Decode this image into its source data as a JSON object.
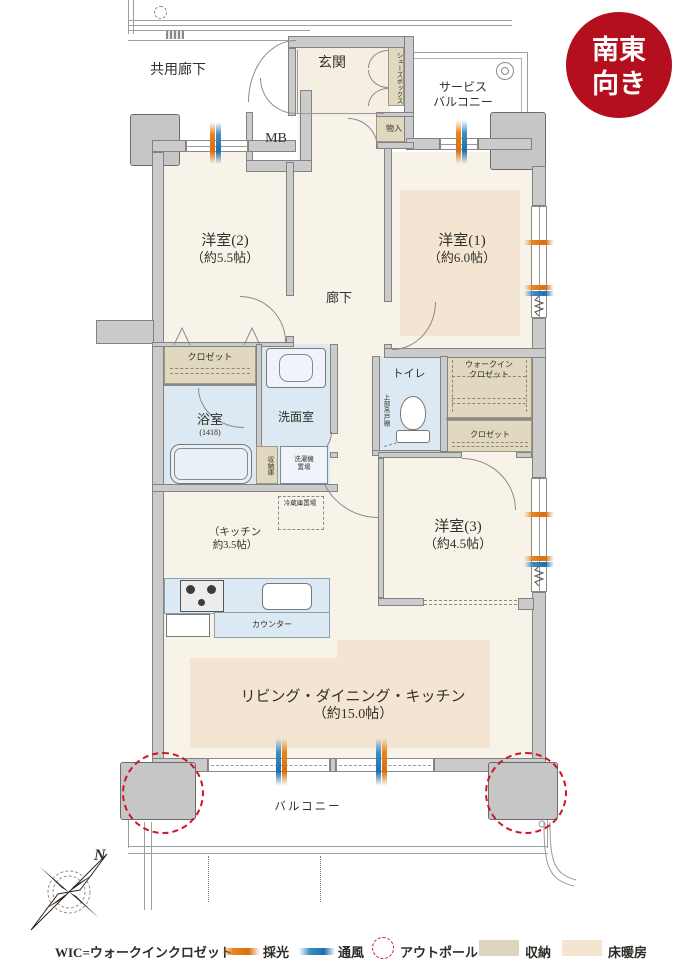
{
  "badge": {
    "line1": "南東",
    "line2": "向き"
  },
  "plan": {
    "common_corridor": "共用廊下",
    "entrance": "玄関",
    "shoe_box": "シューズボックス",
    "service_balcony_line1": "サービス",
    "service_balcony_line2": "バルコニー",
    "meter_box": "MB",
    "storage_in": "物入",
    "bedroom2_name": "洋室(2)",
    "bedroom2_size": "（約5.5帖）",
    "bedroom1_name": "洋室(1)",
    "bedroom1_size": "（約6.0帖）",
    "bedroom3_name": "洋室(3)",
    "bedroom3_size": "（約4.5帖）",
    "corridor": "廊下",
    "closet_bedroom2": "クロゼット",
    "closet_bedroom3": "クロゼット",
    "wic_line1": "ウォークイン",
    "wic_line2": "クロゼット",
    "bathroom": "浴室",
    "bathroom_size": "(1418)",
    "washroom": "洗面室",
    "storage_cabinet": "収納庫",
    "washer_line1": "洗濯機",
    "washer_line2": "置場",
    "fridge_place": "冷蔵庫置場",
    "toilet": "トイレ",
    "upper_shelf": "上部吊戸棚",
    "kitchen_line1": "（キッチン",
    "kitchen_line2": "約3.5帖）",
    "counter": "カウンター",
    "ldk_name": "リビング・ダイニング・キッチン",
    "ldk_size": "（約15.0帖）",
    "balcony": "バルコニー"
  },
  "legend": {
    "wic_note": "WIC=ウォークインクロゼット",
    "daylight": "採光",
    "ventilation": "通風",
    "outpole": "アウトポール",
    "storage": "収納",
    "floor_heating": "床暖房"
  },
  "compass": {
    "north": "N"
  },
  "colors": {
    "badge_red": "#b30f1e",
    "daylight_orange": "#e8821e",
    "ventilation_blue": "#2f84c0",
    "outpole_red": "#cd1628",
    "storage_tan": "#ddd6bf",
    "floor_heating_beige": "#f3e5d1",
    "wet_area_blue": "#dce9f2",
    "wall_gray": "#cbcbcb",
    "floor_cream": "#f7f3e8"
  }
}
